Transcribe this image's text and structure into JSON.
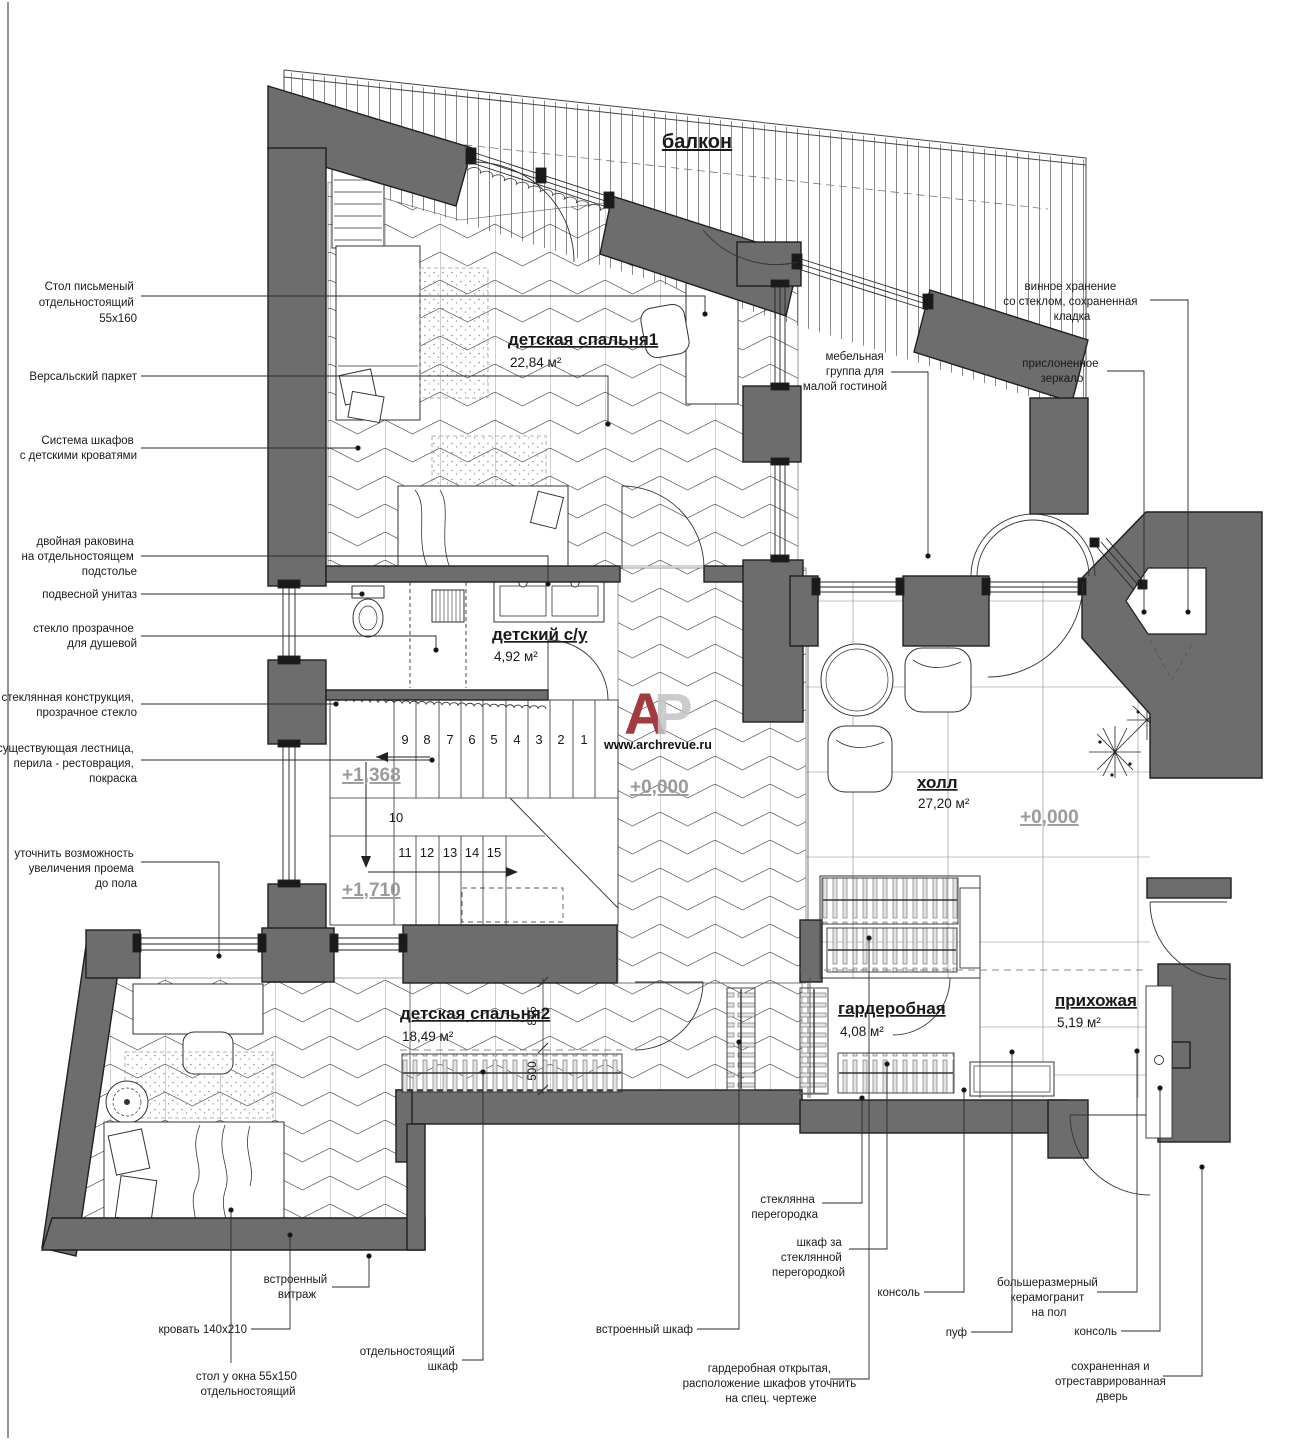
{
  "balcony_label": "балкон",
  "logo": {
    "a": "A",
    "p": "P",
    "site": "www.archrevue.ru"
  },
  "rooms": {
    "bedroom1": {
      "name": "детская спальня1",
      "area": "22,84 м²"
    },
    "bath": {
      "name": "детский с/у",
      "area": "4,92 м²"
    },
    "hall": {
      "name": "холл",
      "area": "27,20 м²"
    },
    "bedroom2": {
      "name": "детская спальня2",
      "area": "18,49 м²"
    },
    "wardrobe": {
      "name": "гардеробная",
      "area": "4,08 м²"
    },
    "entry": {
      "name": "прихожая",
      "area": "5,19 м²"
    }
  },
  "levels": {
    "stair_mid": "+1,368",
    "stair_low": "+1,710",
    "corridor": "+0,000",
    "hall": "+0,000"
  },
  "stairs": {
    "upper": [
      "9",
      "8",
      "7",
      "6",
      "5",
      "4",
      "3",
      "2",
      "1"
    ],
    "landing": "10",
    "lower": [
      "11",
      "12",
      "13",
      "14",
      "15"
    ]
  },
  "dims": {
    "d815": "815",
    "d500": "500"
  },
  "annotations": {
    "desk_standalone": [
      "Стол письменый",
      "отдельностоящий",
      "55х160"
    ],
    "parquet": [
      "Версальский паркет"
    ],
    "closet_system": [
      "Система шкафов",
      "с детскими кроватями"
    ],
    "double_sink": [
      "двойная раковина",
      "на отдельностоящем",
      "подстолье"
    ],
    "wall_hung_wc": [
      "подвесной унитаз"
    ],
    "shower_glass": [
      "стекло прозрачное",
      "для душевой"
    ],
    "glass_construction": [
      "стеклянная конструкция,",
      "прозрачное стекло"
    ],
    "existing_stairs": [
      "существующая лестница,",
      "перила - рестоврация,",
      "покраска"
    ],
    "opening_enlarge": [
      "уточнить возможность",
      "увеличения проема",
      "до пола"
    ],
    "wine_storage": [
      "винное хранение",
      "со стеклом, сохраненная",
      "кладка"
    ],
    "furniture_group": [
      "мебельная",
      "группа для",
      "малой гостиной"
    ],
    "leaning_mirror": [
      "прислоненное",
      "зеркало"
    ],
    "stained_glass": [
      "встроенный",
      "витраж"
    ],
    "bed_size": [
      "кровать 140х210"
    ],
    "window_desk": [
      "стол у окна 55х150",
      "отдельностоящий"
    ],
    "standalone_wardrobe": [
      "отдельностоящий",
      "шкаф"
    ],
    "builtin_wardrobe": [
      "встроенный шкаф"
    ],
    "glass_partition": [
      "стеклянна",
      "перегородка"
    ],
    "wardrobe_behind_glass": [
      "шкаф за",
      "стеклянной",
      "перегородкой"
    ],
    "open_wardrobe": [
      "гардеробная открытая,",
      "расположение шкафов уточнить",
      "на спец. чертеже"
    ],
    "console1": [
      "консоль"
    ],
    "pouf": [
      "пуф"
    ],
    "porcelain_floor": [
      "большеразмерный",
      "керамогранит",
      "на пол"
    ],
    "console2": [
      "консоль"
    ],
    "restored_door": [
      "сохраненная и",
      "отреставрированная",
      "дверь"
    ]
  }
}
